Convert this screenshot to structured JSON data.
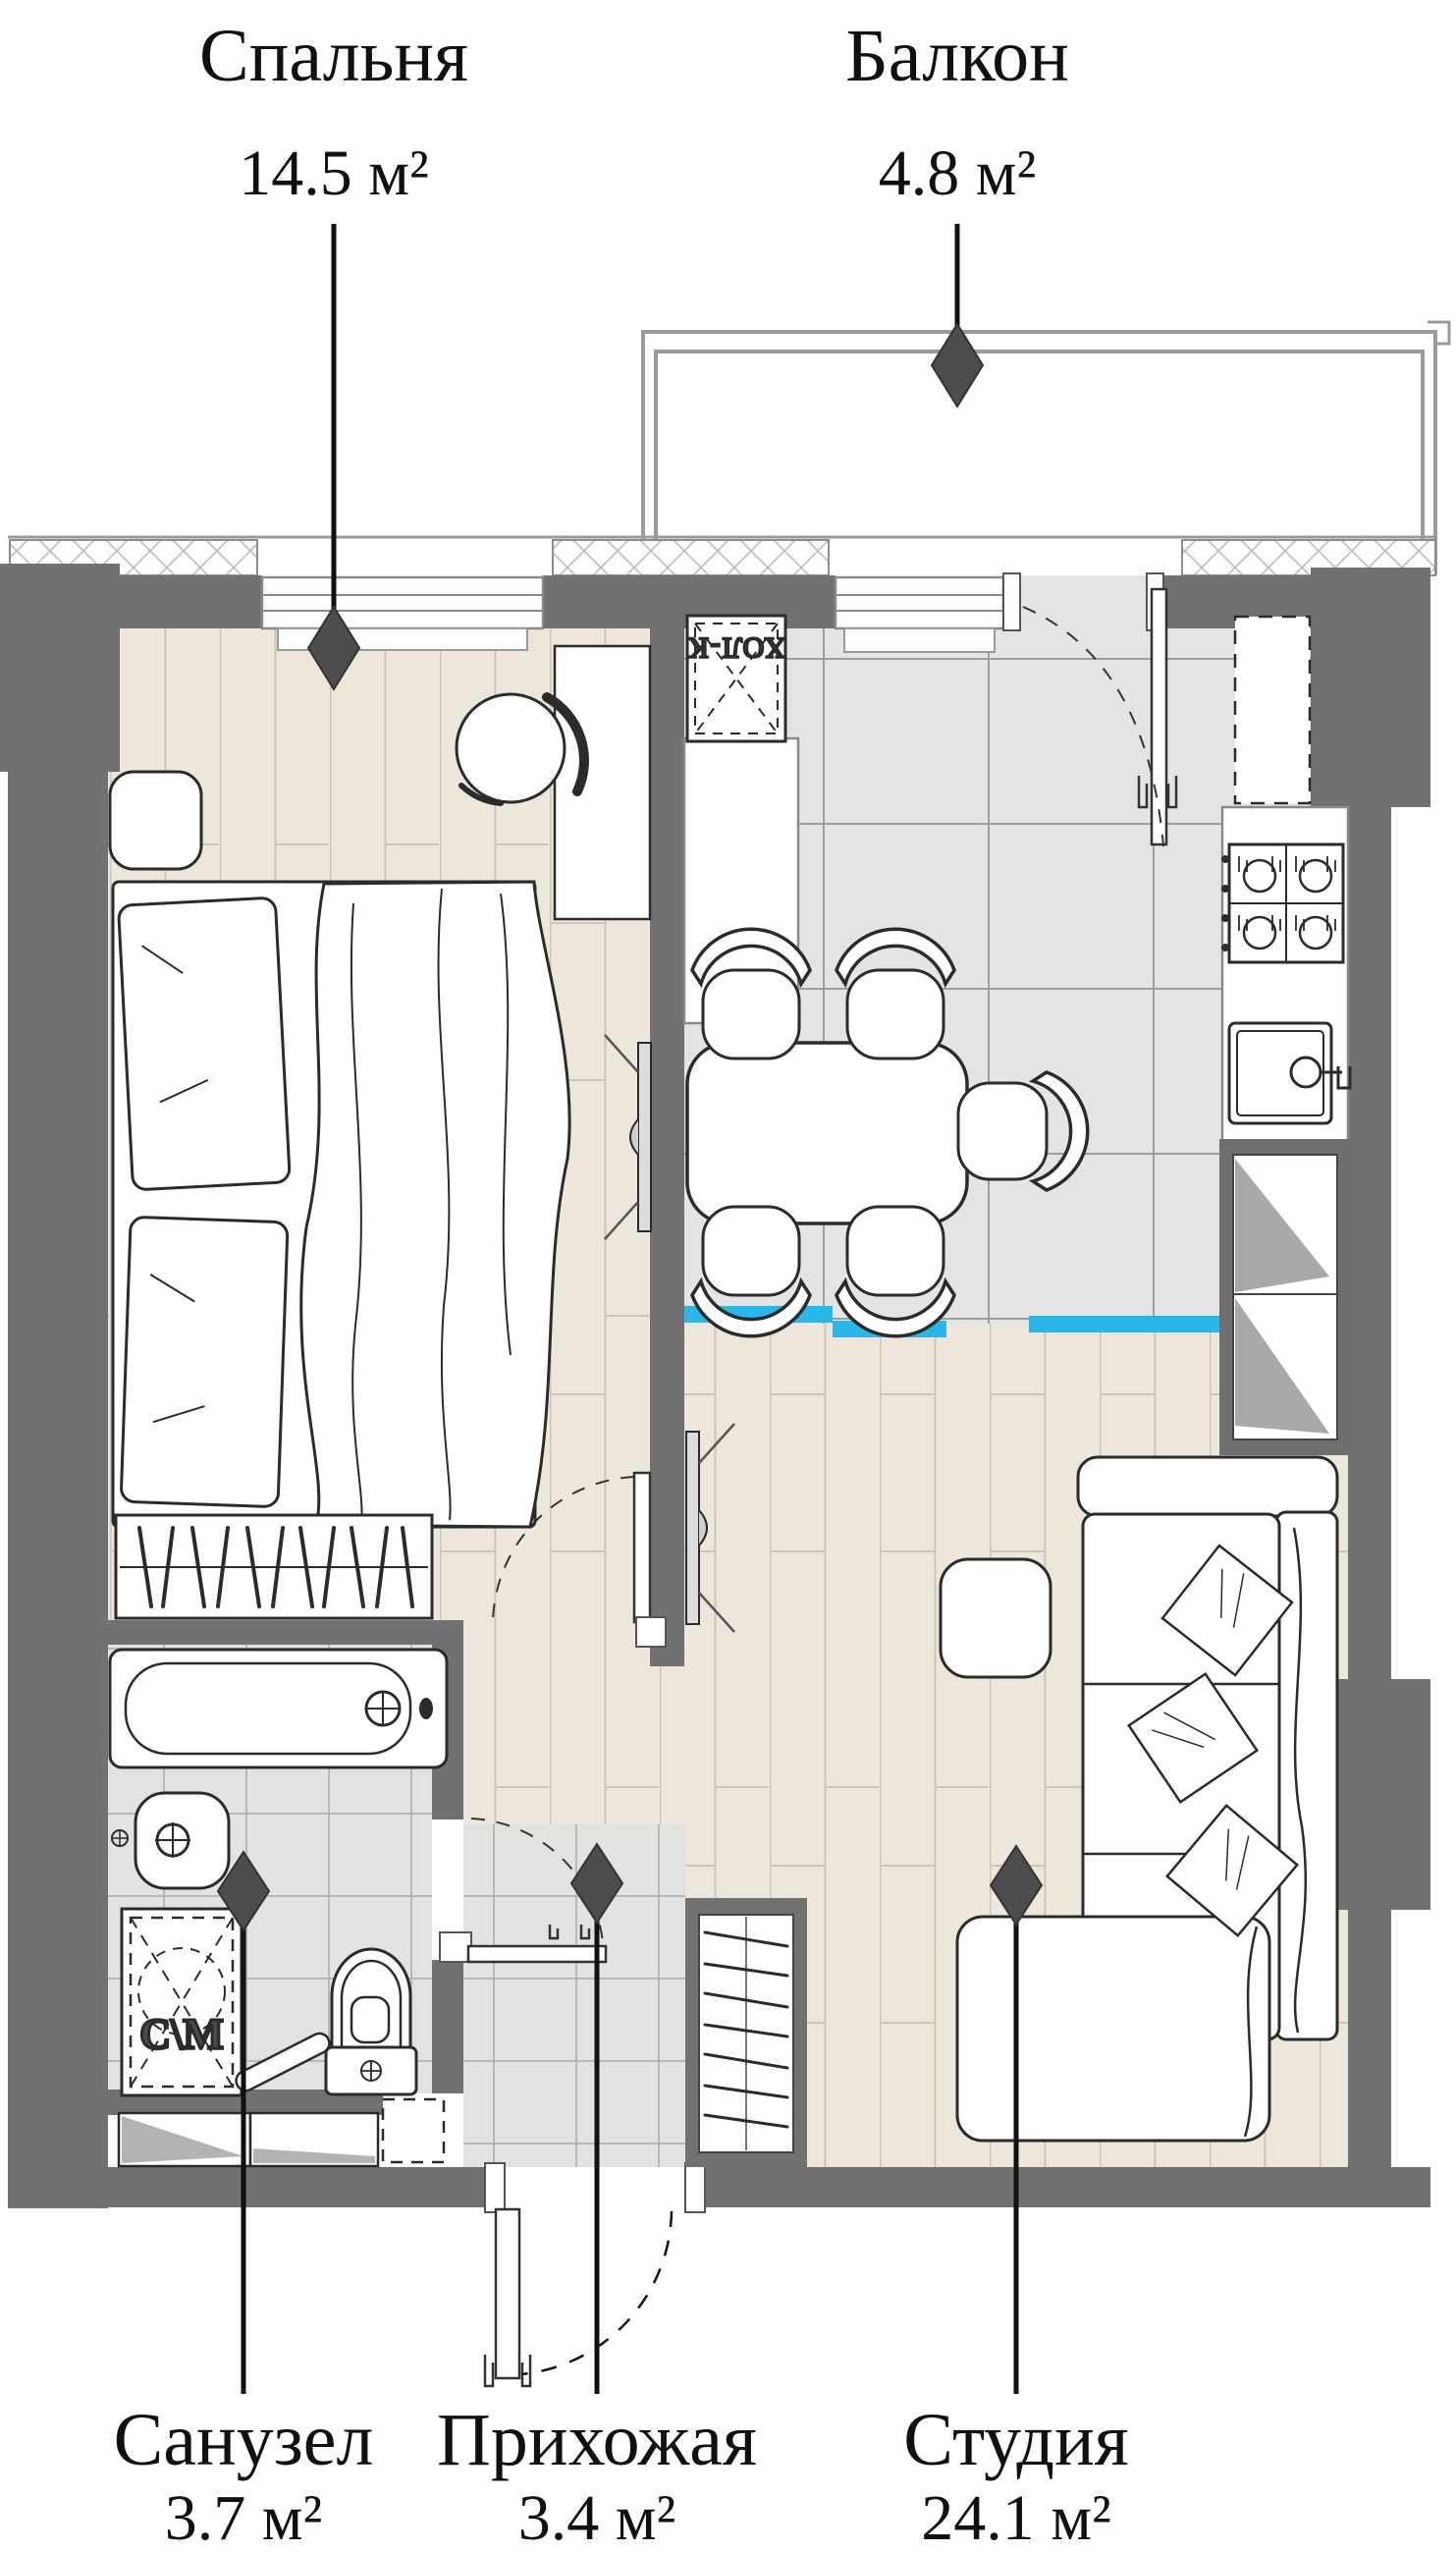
{
  "rooms": {
    "bedroom": {
      "name": "Спальня",
      "area": "14.5 м²"
    },
    "balcony": {
      "name": "Балкон",
      "area": "4.8 м²"
    },
    "bathroom": {
      "name": "Санузел",
      "area": "3.7 м²"
    },
    "hallway": {
      "name": "Прихожая",
      "area": "3.4 м²"
    },
    "studio": {
      "name": "Студия",
      "area": "24.1 м²"
    }
  },
  "appliances": {
    "fridge_label": "ХОЛ-К",
    "washer_label": "С\\М"
  },
  "colors": {
    "wall": "#717171",
    "wood_floor": "#ede6da",
    "tile_floor": "#e4e4e3",
    "threshold_accent": "#29b7ea",
    "marker": "#4d4d4d",
    "balcony_line": "#9a9a9a",
    "furniture_stroke": "#2b2b2b"
  }
}
